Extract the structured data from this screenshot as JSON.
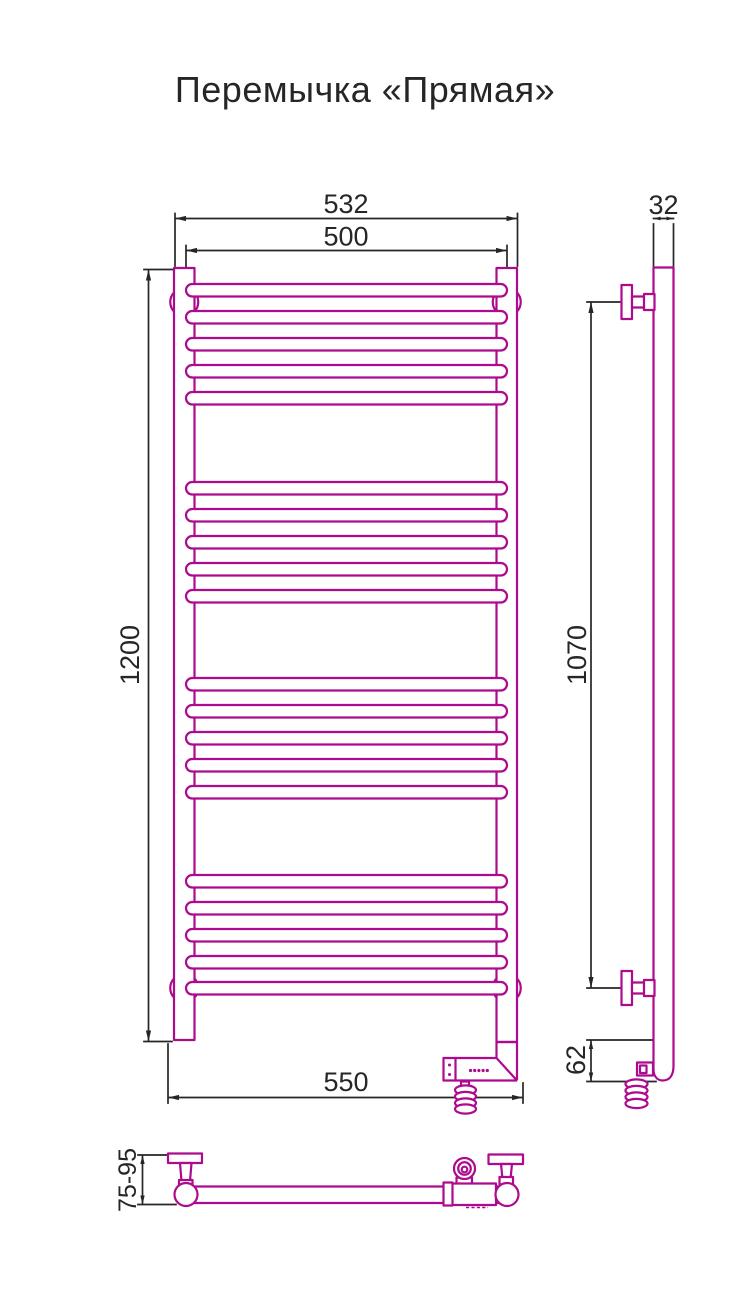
{
  "title": "Перемычка «Прямая»",
  "colors": {
    "drawing": "#ad0a8e",
    "dimension": "#262626"
  },
  "dimensions": {
    "overall_width": "532",
    "bar_width": "500",
    "height": "1200",
    "tube_depth": "32",
    "mounting_height": "1070",
    "bottom_width": "550",
    "bottom_offset": "62",
    "wall_distance": "75-95"
  }
}
